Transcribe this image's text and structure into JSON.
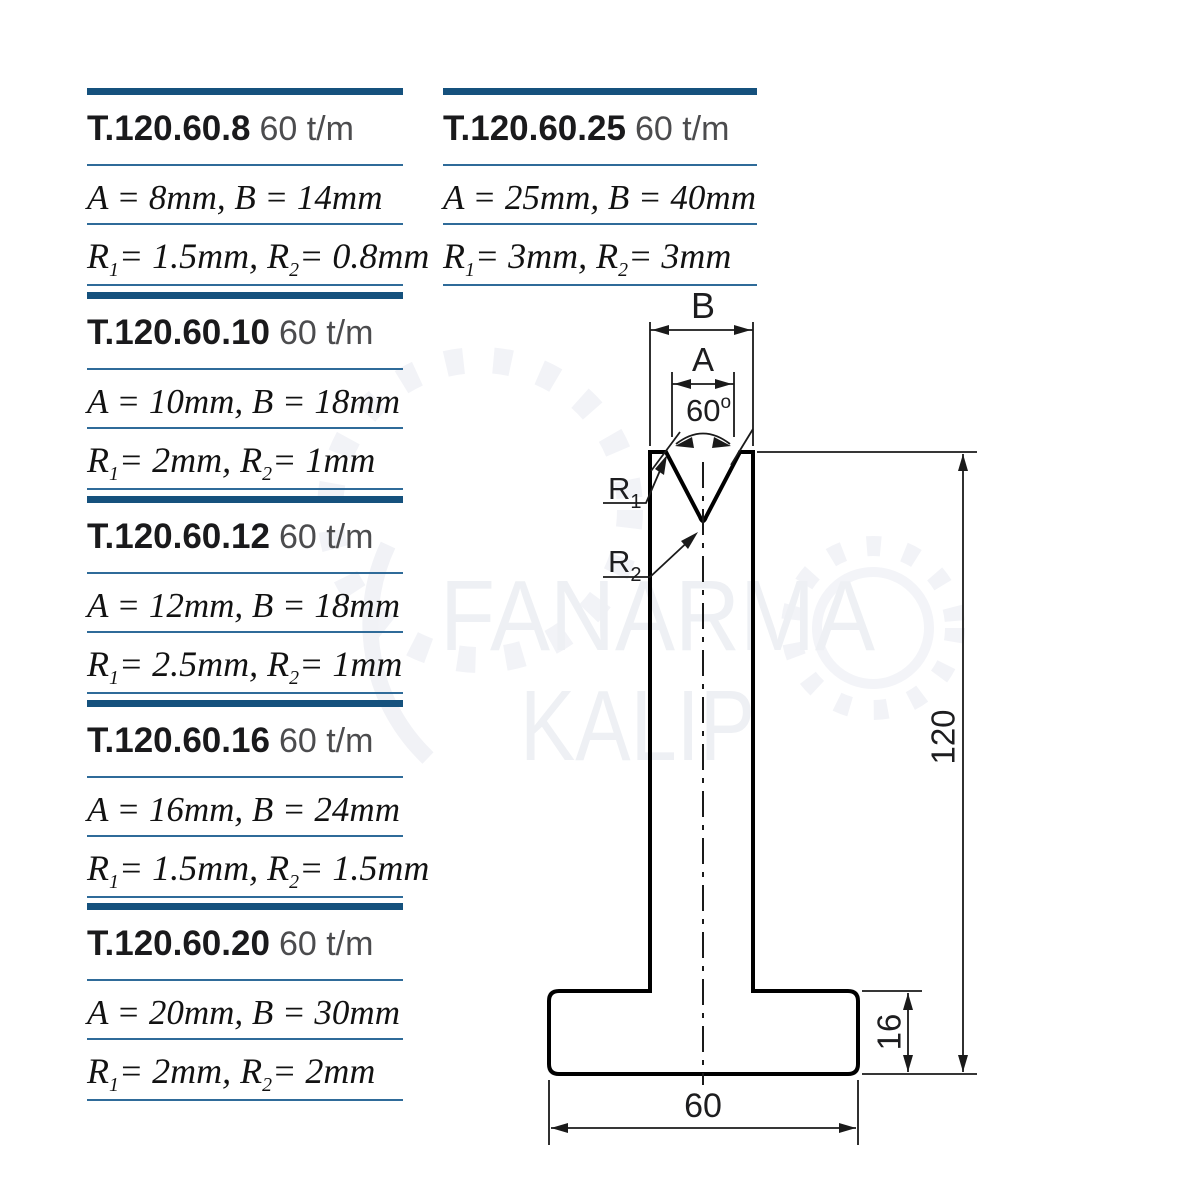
{
  "colors": {
    "thick_bar": "#15517d",
    "thin_rule": "#2f6b99",
    "model_text": "#1a1a1c",
    "tonnage_text": "#4c4c4e",
    "die_fill": "#dcedf1",
    "outline": "#000000",
    "watermark": "#eef0f4"
  },
  "watermark": {
    "line1": "FANARMA",
    "line2": "KALIP"
  },
  "specs": [
    {
      "model": "T.120.60.8",
      "tonnage": "60 t/m",
      "dims": "A = 8mm, B = 14mm",
      "r": [
        "R",
        "1",
        "= 1.5mm, R",
        "2",
        "= 0.8mm"
      ]
    },
    {
      "model": "T.120.60.10",
      "tonnage": "60 t/m",
      "dims": "A = 10mm, B = 18mm",
      "r": [
        "R",
        "1",
        "= 2mm, R",
        "2",
        "= 1mm"
      ]
    },
    {
      "model": "T.120.60.12",
      "tonnage": "60 t/m",
      "dims": "A = 12mm, B = 18mm",
      "r": [
        "R",
        "1",
        "= 2.5mm, R",
        "2",
        "= 1mm"
      ]
    },
    {
      "model": "T.120.60.16",
      "tonnage": "60 t/m",
      "dims": "A = 16mm, B = 24mm",
      "r": [
        "R",
        "1",
        "= 1.5mm, R",
        "2",
        "= 1.5mm"
      ]
    },
    {
      "model": "T.120.60.20",
      "tonnage": "60 t/m",
      "dims": "A = 20mm, B = 30mm",
      "r": [
        "R",
        "1",
        "= 2mm, R",
        "2",
        "= 2mm"
      ]
    },
    {
      "model": "T.120.60.25",
      "tonnage": "60 t/m",
      "dims": "A = 25mm, B = 40mm",
      "r": [
        "R",
        "1",
        "= 3mm, R",
        "2",
        "= 3mm"
      ]
    }
  ],
  "drawing": {
    "labels": {
      "b": "B",
      "a": "A",
      "angle": "60",
      "angle_sup": "o",
      "r_name": "R",
      "r1_sub": "1",
      "r2_sub": "2",
      "height": "120",
      "base_height": "16",
      "base_width": "60"
    }
  }
}
